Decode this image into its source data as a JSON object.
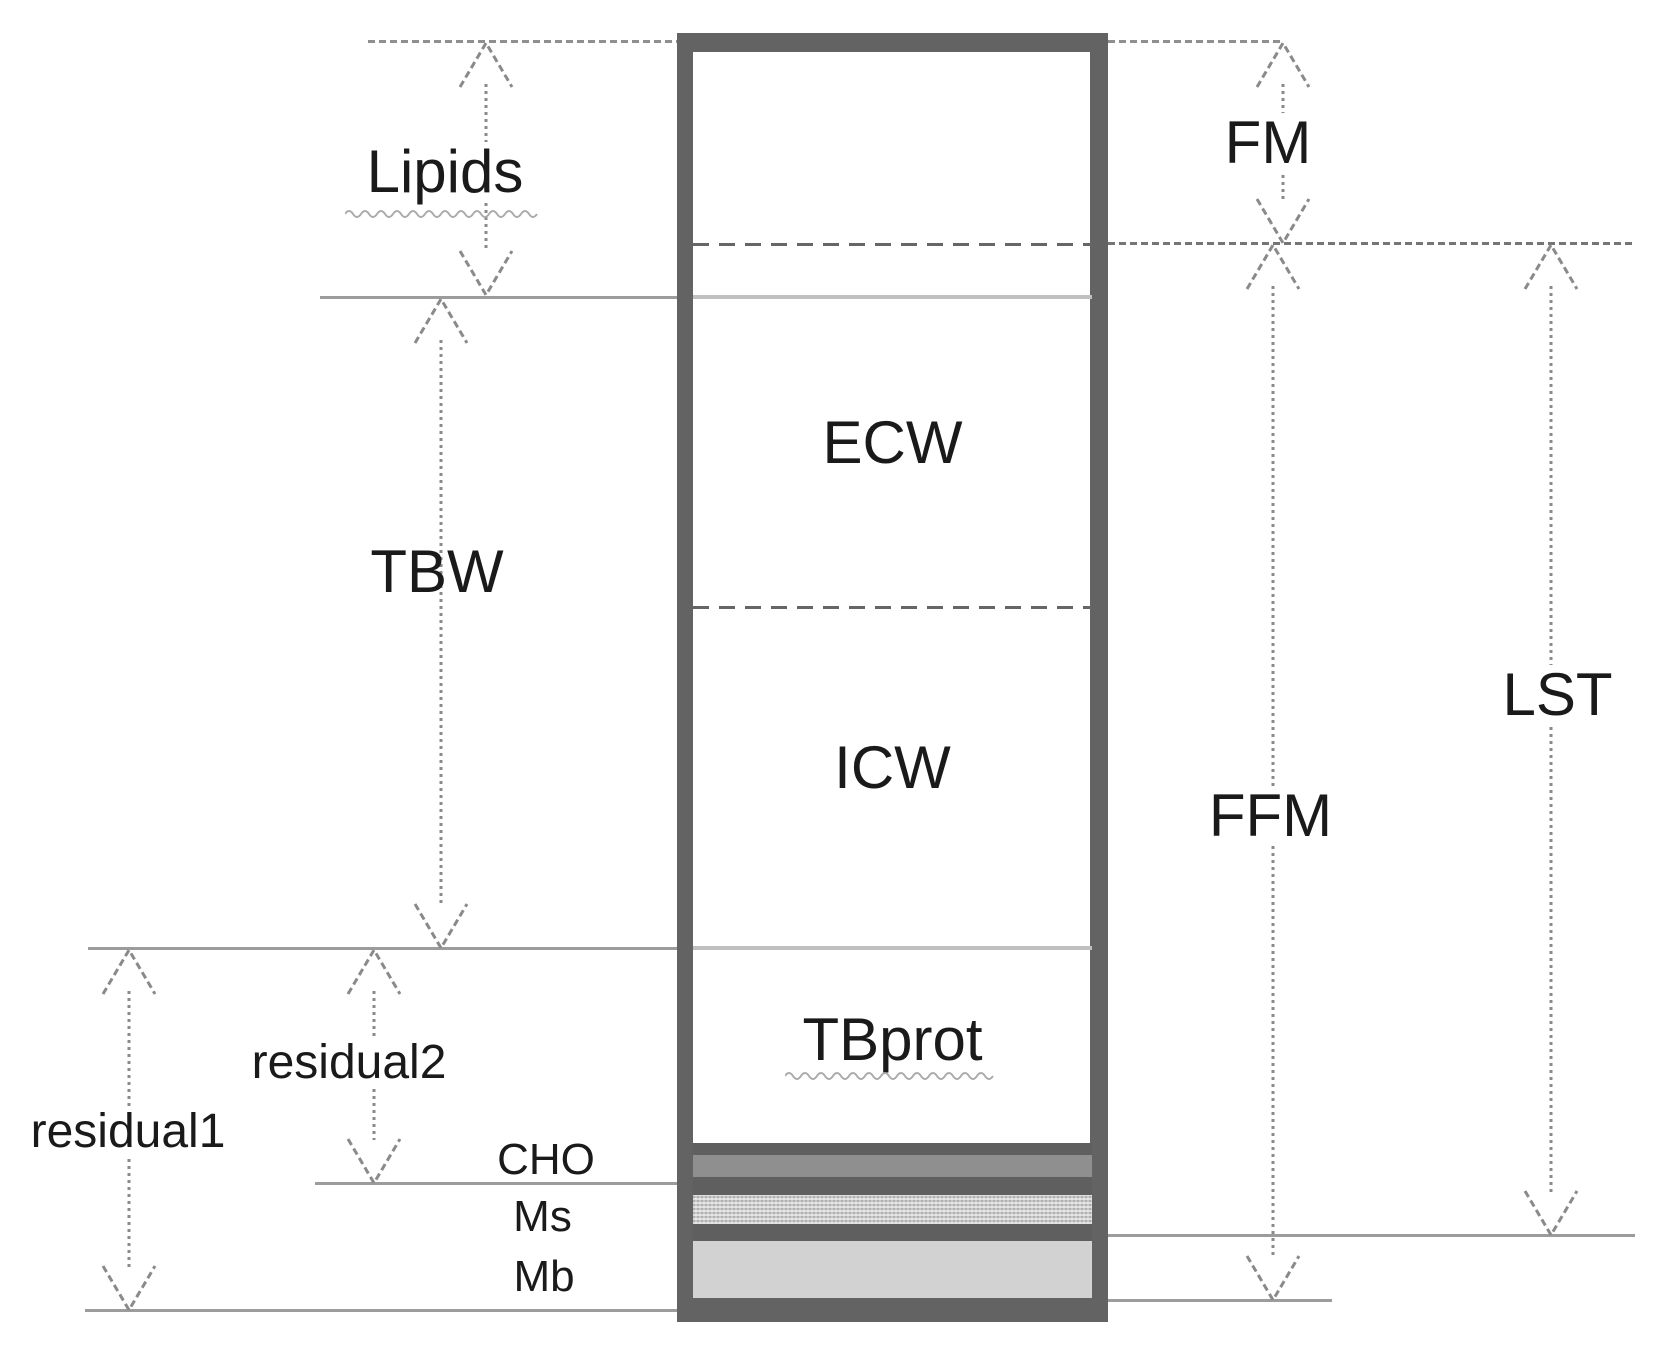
{
  "labels": {
    "lipids": "Lipids",
    "tbw": "TBW",
    "residual1": "residual1",
    "residual2": "residual2",
    "cho": "CHO",
    "ms": "Ms",
    "mb": "Mb",
    "ecw": "ECW",
    "icw": "ICW",
    "tbprot": "TBprot",
    "fm": "FM",
    "ffm": "FFM",
    "lst": "LST"
  },
  "colors": {
    "structure_border": "#636363",
    "band_dark": "#5f5f5f",
    "cho_fill": "#8f8f8f",
    "ms_fill": "#c9c9c9",
    "mb_fill": "#d2d2d2",
    "dimension_line": "#8f8f8f",
    "inner_boundary_line": "#c0c0c0",
    "text": "#1a1a1a"
  }
}
